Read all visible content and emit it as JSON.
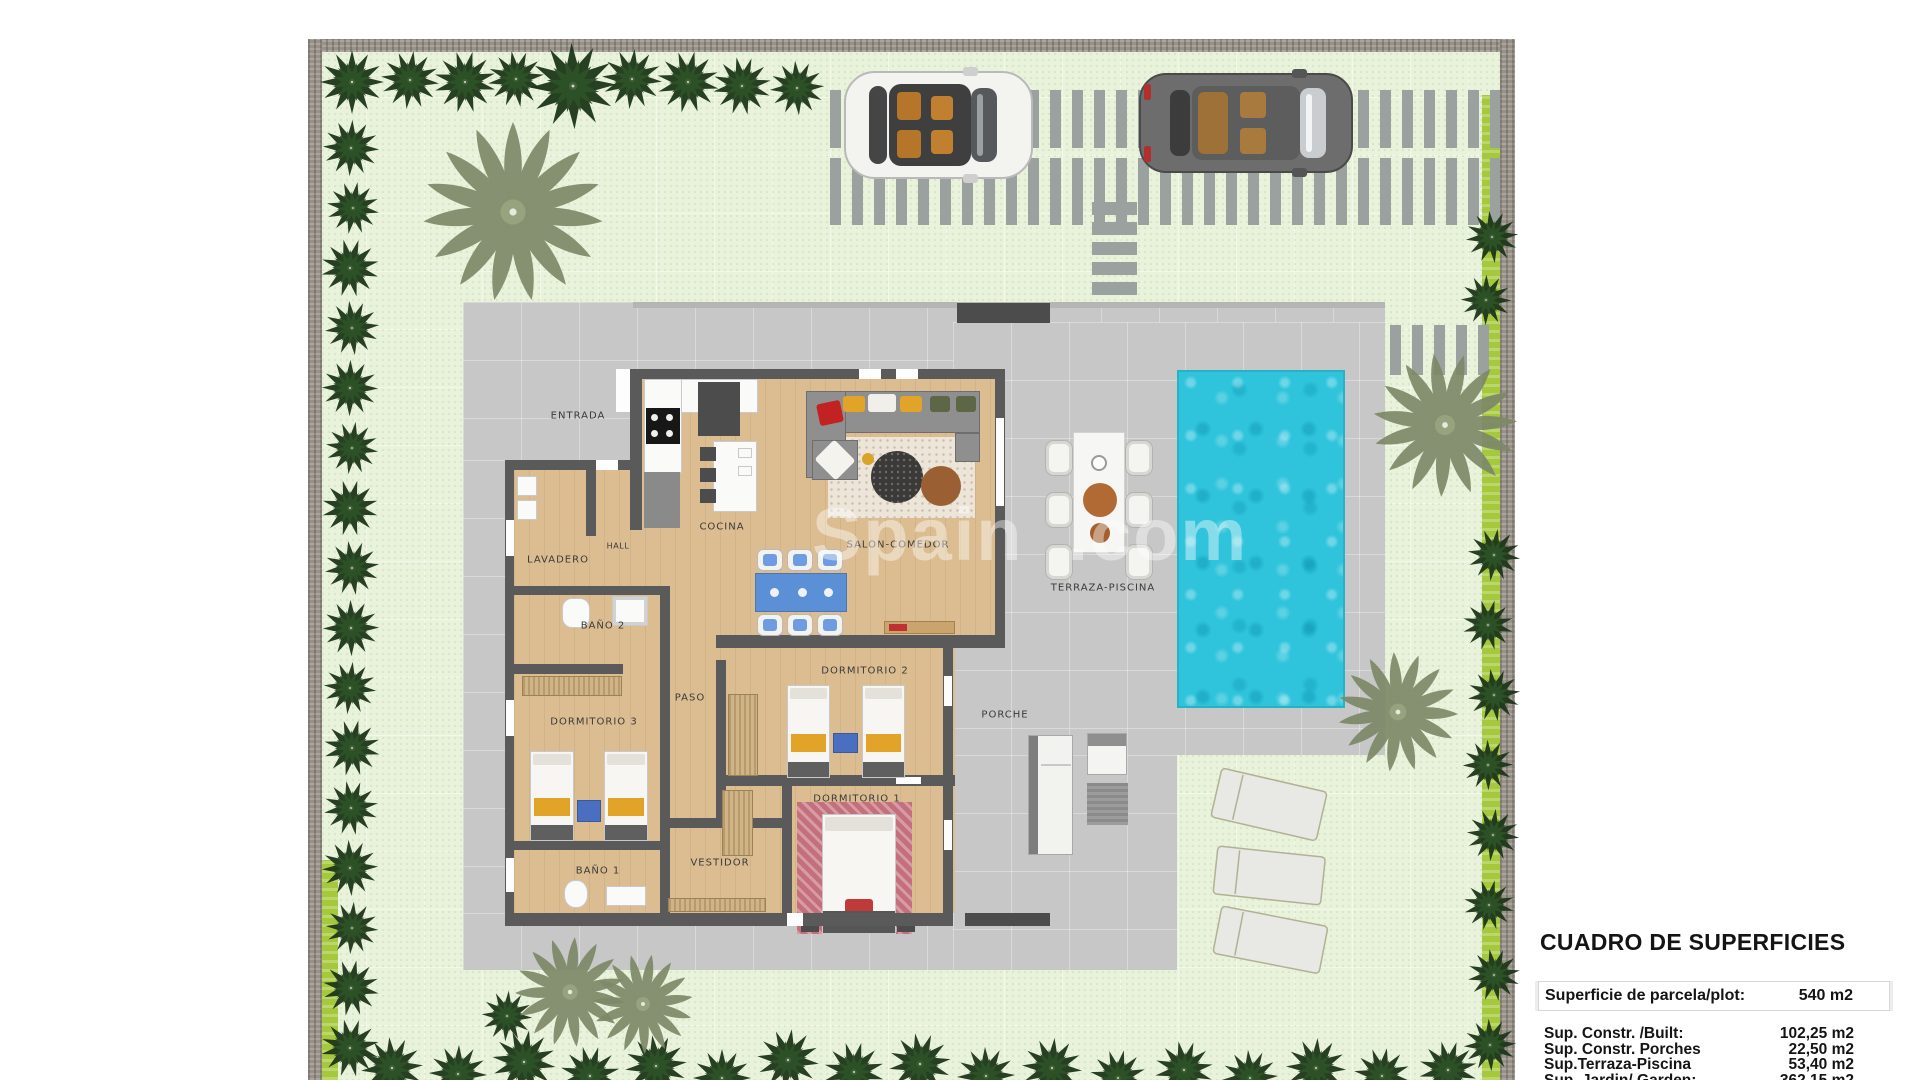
{
  "plan": {
    "room_labels": [
      {
        "id": "entrada",
        "label": "ENTRADA"
      },
      {
        "id": "cocina",
        "label": "COCINA"
      },
      {
        "id": "salon-comedor",
        "label": "SALON-COMEDOR"
      },
      {
        "id": "lavadero",
        "label": "LAVADERO"
      },
      {
        "id": "hall",
        "label": "HALL"
      },
      {
        "id": "bano-2",
        "label": "BAÑO 2"
      },
      {
        "id": "dormitorio-3",
        "label": "DORMITORIO 3"
      },
      {
        "id": "paso",
        "label": "PASO"
      },
      {
        "id": "dormitorio-2",
        "label": "DORMITORIO 2"
      },
      {
        "id": "dormitorio-1",
        "label": "DORMITORIO 1"
      },
      {
        "id": "bano-1",
        "label": "BAÑO 1"
      },
      {
        "id": "vestidor",
        "label": "VESTIDOR"
      },
      {
        "id": "porche",
        "label": "PORCHE"
      },
      {
        "id": "terraza-piscina",
        "label": "TERRAZA-PISCINA"
      }
    ],
    "watermark_left": "Spain",
    "watermark_right": ".com"
  },
  "surface_table": {
    "title": "CUADRO DE SUPERFICIES",
    "parcel_row": {
      "label": "Superficie de parcela/plot:",
      "value": "540 m2"
    },
    "rows": [
      {
        "label": "Sup. Constr. /Built:",
        "value": "102,25 m2"
      },
      {
        "label": "Sup. Constr. Porches",
        "value": "22,50 m2"
      },
      {
        "label": "Sup.Terraza-Piscina",
        "value": "53,40 m2"
      },
      {
        "label": "Sup. Jardin/ Garden:",
        "value": "362,15 m2"
      }
    ]
  },
  "colors": {
    "grass": "#e9f2db",
    "paving": "#c7c7c7",
    "pool": "#2fc4dc",
    "wall": "#5a5a5a",
    "boundary_wall": "#97918a",
    "hedge": "#a6c83d",
    "wood_floor": "#dcbd92",
    "dining_blue": "#5b8fd6",
    "accent_yellow": "#e2a428",
    "tree_dark": "#1d3619",
    "palm_olive": "#7d8968"
  }
}
